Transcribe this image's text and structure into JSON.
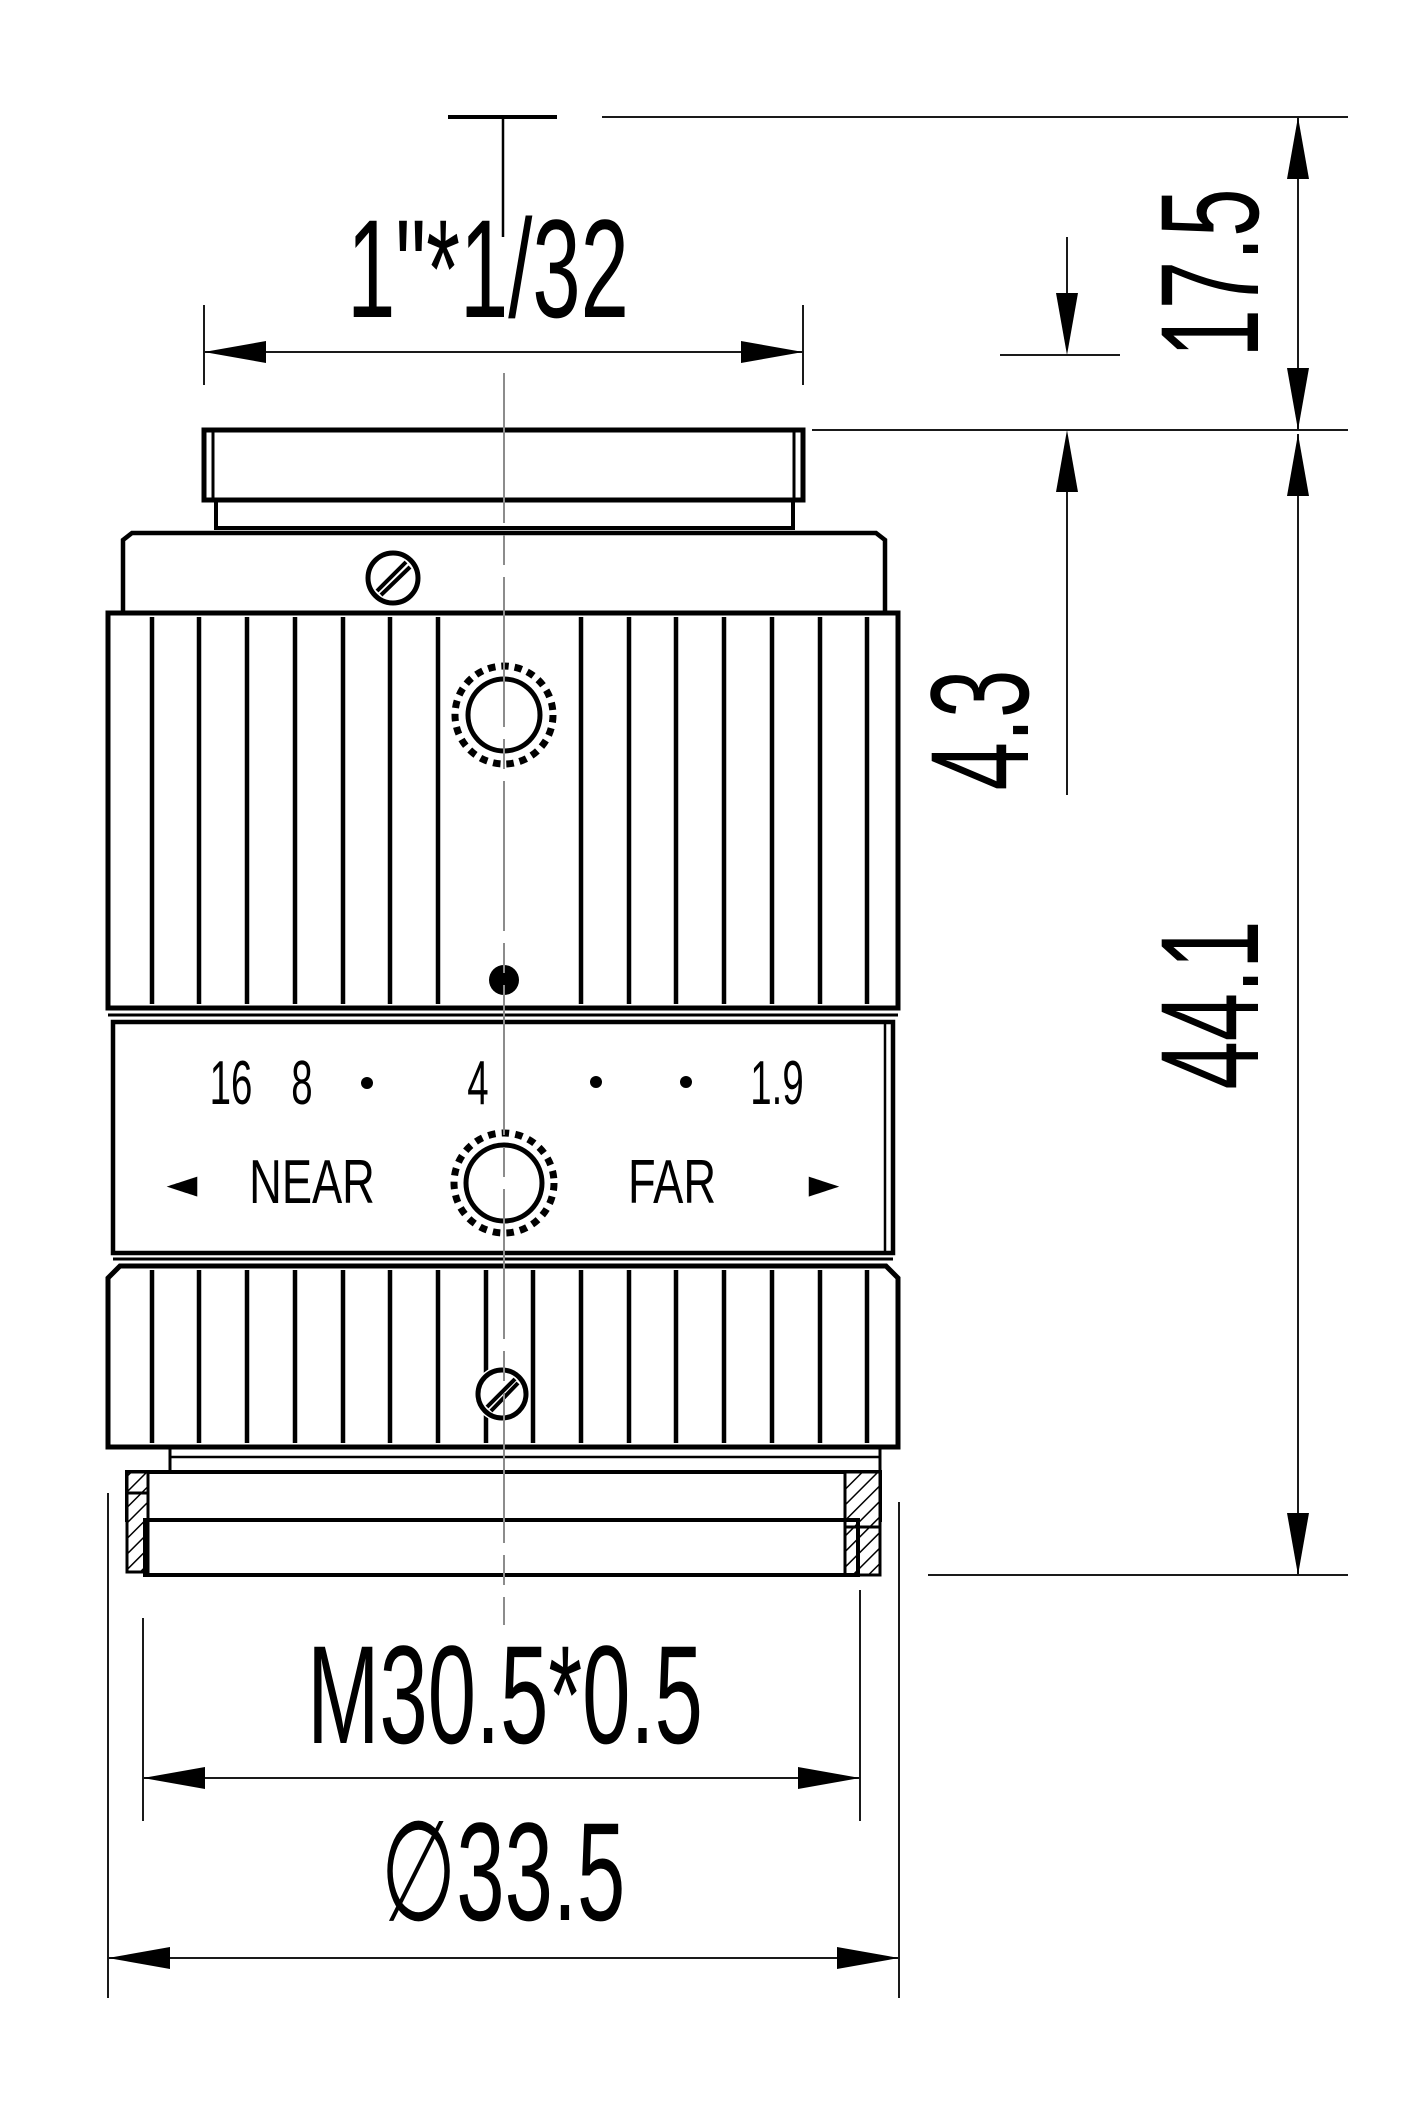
{
  "drawing": {
    "labels": {
      "mount_thread_top": "1\"*1/32",
      "flange_focal_distance": "17.5",
      "rear_protrusion": "4.3",
      "body_length": "44.1",
      "bottom_thread": "M30.5*0.5",
      "outer_diameter": "∅33.5"
    },
    "aperture_ring": {
      "f16": "16",
      "f8": "8",
      "f4": "4",
      "f1_9": "1.9"
    },
    "focus_ring": {
      "near": "NEAR",
      "far": "FAR",
      "near_arrow": "◄",
      "far_arrow": "►"
    },
    "colors": {
      "line": "#000000",
      "dimension_line": "#1a1a1a",
      "centerline": "#8c8c8c",
      "background": "#ffffff"
    }
  }
}
